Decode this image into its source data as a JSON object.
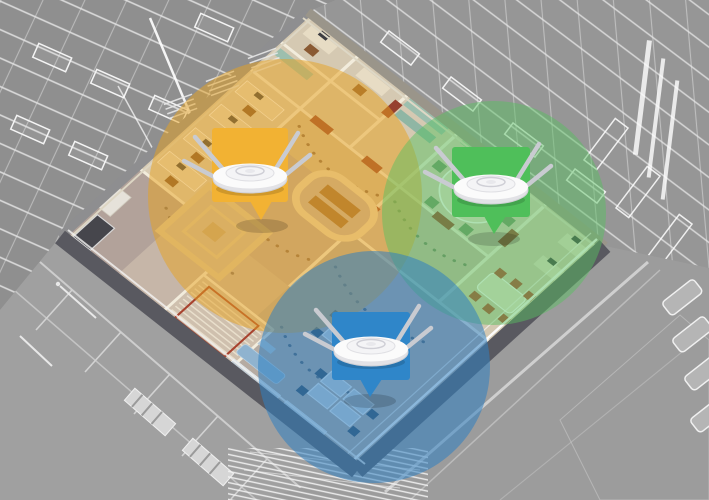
{
  "scene": {
    "description": "Isometric cutaway of an office floor with three ceiling wireless access points and color-coded Wi-Fi coverage circles, surrounded by gray wireframe buildings and streets",
    "background_color": "#9a9a9a",
    "building_floor_color": "#c6b6a8",
    "wall_cut_color": "#5a5a61",
    "wireframe_line_color": "#ececec"
  },
  "zones": [
    {
      "id": "zone-a",
      "position": "upper-left",
      "callout_color": "#f2b233",
      "coverage_fill": "rgba(231,162,30,0.50)"
    },
    {
      "id": "zone-b",
      "position": "upper-right",
      "callout_color": "#4fbf5a",
      "coverage_fill": "rgba(88,192,97,0.48)"
    },
    {
      "id": "zone-c",
      "position": "bottom-center",
      "callout_color": "#2f86c9",
      "coverage_fill": "rgba(47,127,193,0.55)"
    }
  ],
  "access_point": {
    "type": "ceiling-mount-wireless-access-point",
    "body_color": "#fbfbfb",
    "antenna_color": "#c9cbd1",
    "antenna_count": 4,
    "count": 3
  }
}
